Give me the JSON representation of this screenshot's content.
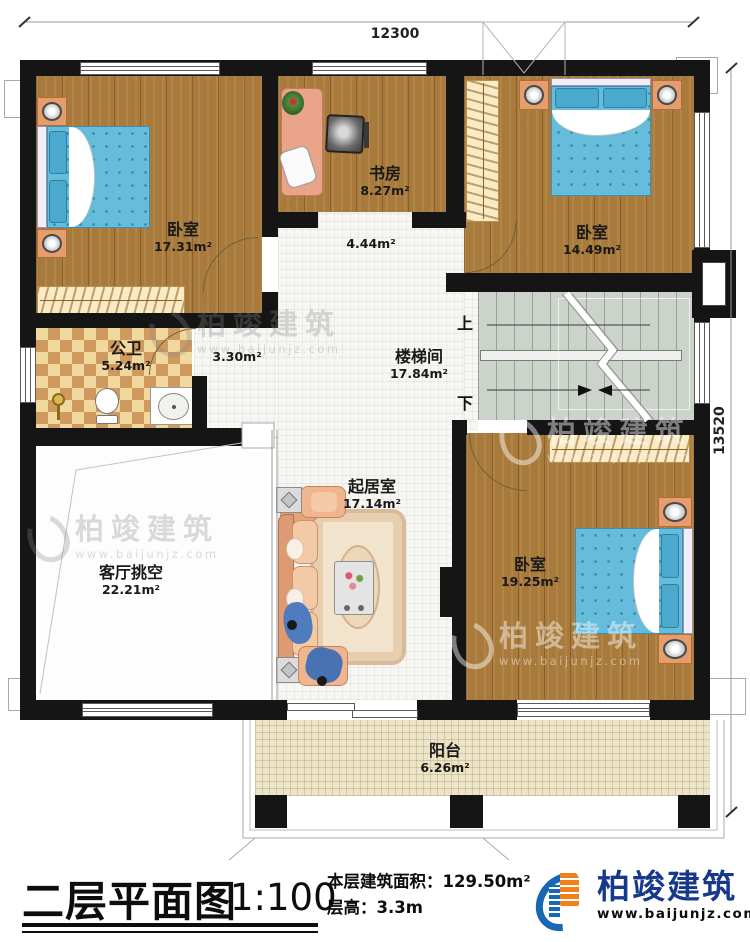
{
  "dimensions": {
    "top": "12300",
    "right": "13520"
  },
  "rooms": {
    "bedroom1": {
      "name": "卧室",
      "area": "17.31m²"
    },
    "study": {
      "name": "书房",
      "area": "8.27m²"
    },
    "hall": {
      "area": "4.44m²"
    },
    "bedroom2": {
      "name": "卧室",
      "area": "14.49m²"
    },
    "bathroom": {
      "name": "公卫",
      "area": "5.24m²"
    },
    "corridor": {
      "area": "3.30m²"
    },
    "stairwell": {
      "name": "楼梯间",
      "area": "17.84m²"
    },
    "living": {
      "name": "起居室",
      "area": "17.14m²"
    },
    "void": {
      "name": "客厅挑空",
      "area": "22.21m²"
    },
    "bedroom3": {
      "name": "卧室",
      "area": "19.25m²"
    },
    "balcony": {
      "name": "阳台",
      "area": "6.26m²"
    }
  },
  "stairs": {
    "up": "上",
    "down": "下"
  },
  "titleblock": {
    "title": "二层平面图",
    "scale": "1:100",
    "area_label": "本层建筑面积：",
    "area_value": "129.50m²",
    "height_label": "层高：",
    "height_value": "3.3m"
  },
  "brand": {
    "name": "柏竣建筑",
    "url": "www.baijunjz.com"
  },
  "watermark": {
    "name": "柏竣建筑",
    "url": "www.baijunjz.com"
  },
  "colors": {
    "wall": "#151515",
    "wood": "#a87b3d",
    "bed": "#66bcdb",
    "brand_blue": "#17398c",
    "brand_orange": "#f08118"
  }
}
